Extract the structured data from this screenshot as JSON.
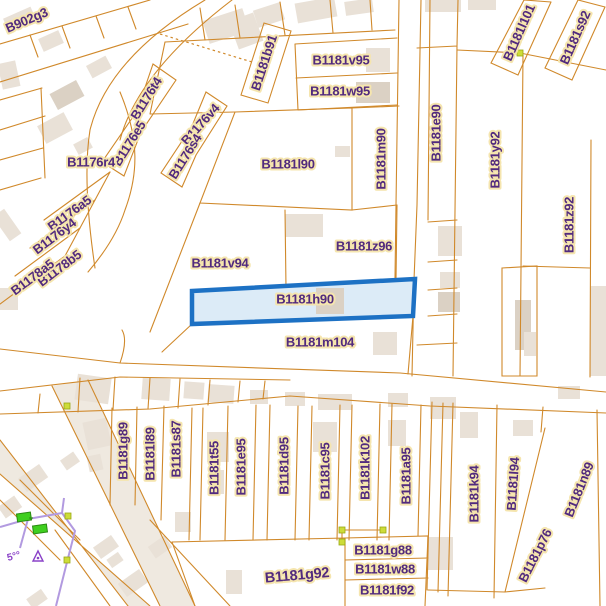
{
  "map": {
    "palette": {
      "background": "#ffffff",
      "parcel_line": "#d0892b",
      "parcel_line_light": "#e0a85c",
      "building_fill": "#e9e1d7",
      "building_fill_dark": "#dbd1c4",
      "road_fill": "#efe9e0",
      "label_text": "#512a7e",
      "label_halo": "#f5e5ae",
      "highlight_stroke": "#1d71c4",
      "highlight_fill": "#dcebf7",
      "vertex_dot": "#cddc39",
      "boundary_purple": "#b29ae0",
      "poi_green": "#3fcf1f",
      "survey_purple": "#8a42c8"
    },
    "highlighted_parcel": {
      "label": "B1181h90"
    },
    "survey_marks": {
      "corner_text": "5°°"
    },
    "labels": [
      {
        "text": "B902g3",
        "x": 27,
        "y": 21,
        "r": -23,
        "fs": 13
      },
      {
        "text": "B1176t4",
        "x": 147,
        "y": 99,
        "r": -58,
        "fs": 13
      },
      {
        "text": "B1176v4",
        "x": 201,
        "y": 125,
        "r": -48,
        "fs": 13
      },
      {
        "text": "B1176e5",
        "x": 130,
        "y": 144,
        "r": -58,
        "fs": 13
      },
      {
        "text": "B1176s4",
        "x": 186,
        "y": 157,
        "r": -58,
        "fs": 13
      },
      {
        "text": "B1176r4",
        "x": 91,
        "y": 163,
        "r": 0,
        "fs": 13
      },
      {
        "text": "B1176a5",
        "x": 70,
        "y": 214,
        "r": -36,
        "fs": 13
      },
      {
        "text": "B1176y4",
        "x": 55,
        "y": 237,
        "r": -37,
        "fs": 13
      },
      {
        "text": "B1178b5",
        "x": 60,
        "y": 269,
        "r": -37,
        "fs": 13
      },
      {
        "text": "B1178a5",
        "x": 33,
        "y": 278,
        "r": -37,
        "fs": 13
      },
      {
        "text": "B1181b91",
        "x": 265,
        "y": 63,
        "r": -72,
        "fs": 13
      },
      {
        "text": "B1181v95",
        "x": 341,
        "y": 61,
        "r": 0,
        "fs": 13
      },
      {
        "text": "B1181w95",
        "x": 340,
        "y": 92,
        "r": 0,
        "fs": 13
      },
      {
        "text": "B1181l90",
        "x": 288,
        "y": 165,
        "r": 0,
        "fs": 13
      },
      {
        "text": "B1181m90",
        "x": 382,
        "y": 159,
        "r": -90,
        "fs": 13
      },
      {
        "text": "B1181e90",
        "x": 437,
        "y": 133,
        "r": -90,
        "fs": 13
      },
      {
        "text": "B1181y92",
        "x": 496,
        "y": 160,
        "r": -90,
        "fs": 13
      },
      {
        "text": "B1181l101",
        "x": 520,
        "y": 33,
        "r": -66,
        "fs": 13
      },
      {
        "text": "B1181s92",
        "x": 576,
        "y": 38,
        "r": -66,
        "fs": 13
      },
      {
        "text": "B1181z92",
        "x": 570,
        "y": 225,
        "r": -90,
        "fs": 13
      },
      {
        "text": "B1181v94",
        "x": 220,
        "y": 264,
        "r": 0,
        "fs": 13
      },
      {
        "text": "B1181z96",
        "x": 364,
        "y": 247,
        "r": 0,
        "fs": 13
      },
      {
        "text": "B1181h90",
        "x": 305,
        "y": 300,
        "r": 0,
        "fs": 13
      },
      {
        "text": "B1181m104",
        "x": 320,
        "y": 343,
        "r": 0,
        "fs": 13
      },
      {
        "text": "B1181g89",
        "x": 124,
        "y": 451,
        "r": -90,
        "fs": 13
      },
      {
        "text": "B1181l89",
        "x": 151,
        "y": 454,
        "r": -90,
        "fs": 13
      },
      {
        "text": "B1181s87",
        "x": 177,
        "y": 449,
        "r": -90,
        "fs": 13
      },
      {
        "text": "B1181t55",
        "x": 215,
        "y": 468,
        "r": -90,
        "fs": 13
      },
      {
        "text": "B1181e95",
        "x": 242,
        "y": 467,
        "r": -90,
        "fs": 13
      },
      {
        "text": "B1181d95",
        "x": 285,
        "y": 466,
        "r": -90,
        "fs": 13
      },
      {
        "text": "B1181c95",
        "x": 326,
        "y": 471,
        "r": -90,
        "fs": 13
      },
      {
        "text": "B1181k102",
        "x": 366,
        "y": 468,
        "r": -90,
        "fs": 13
      },
      {
        "text": "B1181a95",
        "x": 407,
        "y": 476,
        "r": -90,
        "fs": 13
      },
      {
        "text": "B1181k94",
        "x": 475,
        "y": 494,
        "r": -90,
        "fs": 13
      },
      {
        "text": "B1181l94",
        "x": 514,
        "y": 484,
        "r": -86,
        "fs": 13
      },
      {
        "text": "B1181n89",
        "x": 580,
        "y": 490,
        "r": -68,
        "fs": 13
      },
      {
        "text": "B1181p76",
        "x": 536,
        "y": 556,
        "r": -63,
        "fs": 13
      },
      {
        "text": "B1181g88",
        "x": 383,
        "y": 551,
        "r": 0,
        "fs": 13
      },
      {
        "text": "B1181w88",
        "x": 385,
        "y": 570,
        "r": 0,
        "fs": 13
      },
      {
        "text": "B1181f92",
        "x": 387,
        "y": 591,
        "r": 0,
        "fs": 13
      },
      {
        "text": "B1181g92",
        "x": 297,
        "y": 576,
        "r": -5,
        "fs": 14.5
      }
    ]
  }
}
